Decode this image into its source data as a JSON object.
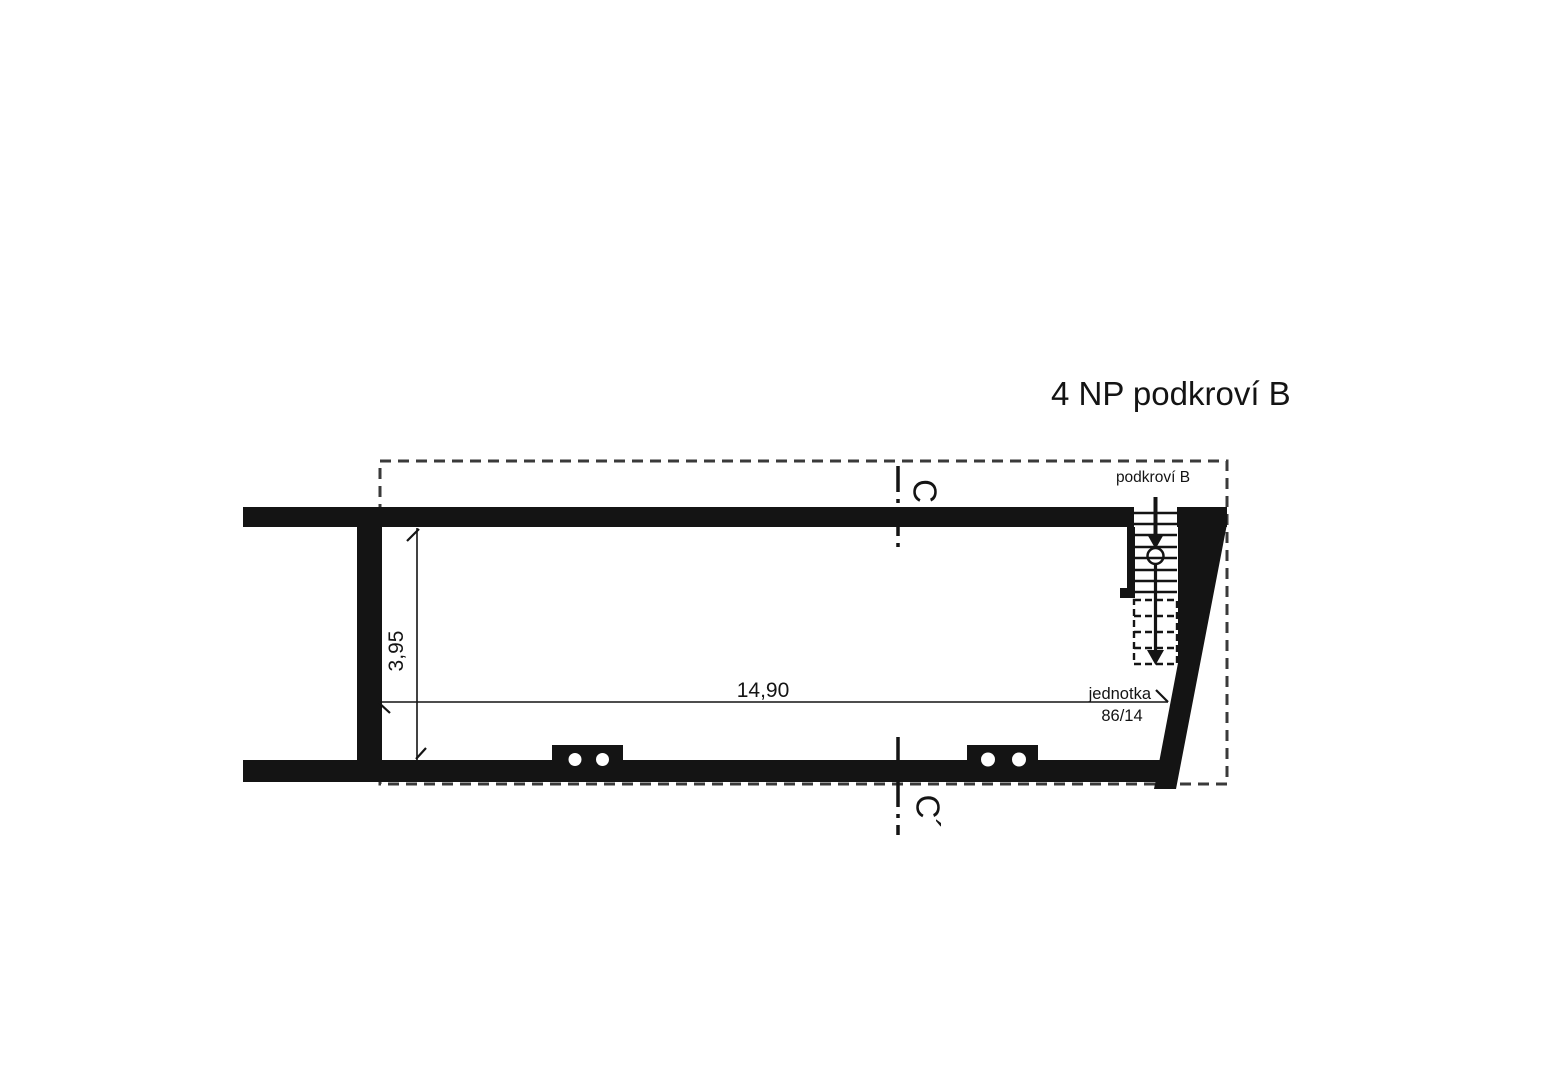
{
  "drawing": {
    "title": "4 NP podkroví B",
    "area_label": "podkroví B",
    "unit": {
      "label": "jednotka",
      "number": "86/14"
    },
    "section": {
      "top": "C",
      "bottom": "C´"
    },
    "dimensions": {
      "width_m": "14,90",
      "height_m": "3,95"
    }
  },
  "colors": {
    "ink": "#141414",
    "boundary": "#3a3a3a",
    "background": "#ffffff"
  }
}
